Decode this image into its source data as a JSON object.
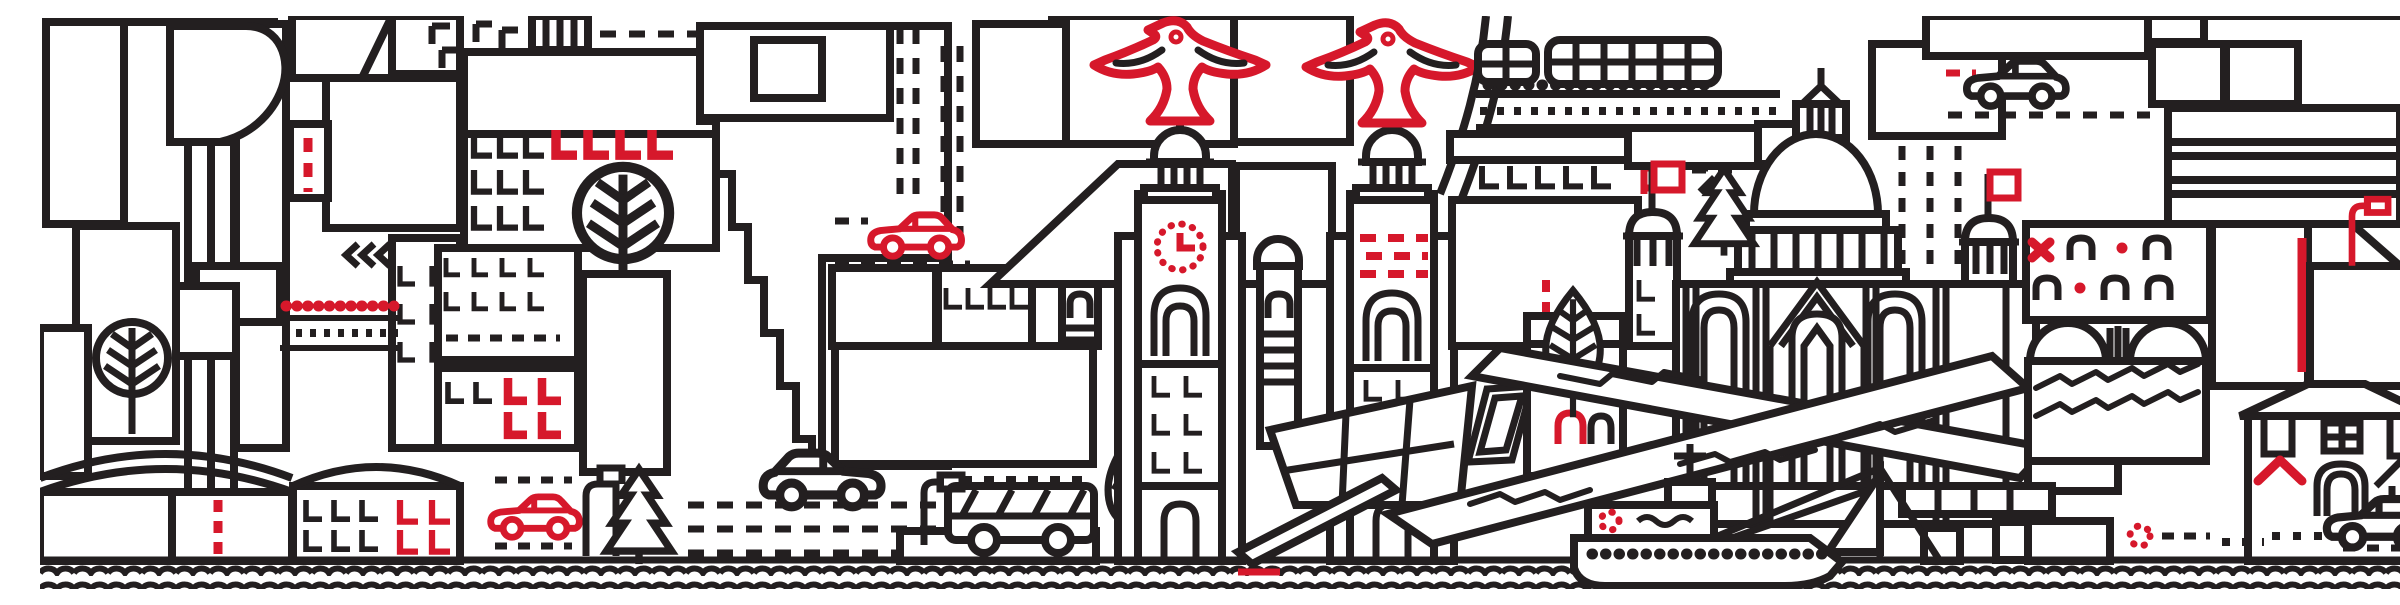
{
  "meta": {
    "title": "Liverpool city skyline line-art illustration",
    "type": "illustration",
    "width_px": 2400,
    "height_px": 573
  },
  "colors": {
    "background": "#ffffff",
    "line": "#231f20",
    "accent": "#d6182b"
  },
  "scene": {
    "description": "Continuous monochrome line-art cityscape of Liverpool with red accents: patterned tower blocks, the Liver Building with two red liver birds and a red dotted clock face, a railway viaduct with a train, a ribbed dome hall with red flags, an arched cathedral facade, crossing museum wedges, a glass ferry terminal, gabled houses, street scenes with cars, a bus, trees and lamps, a ferry ship and sailboat, all above a double wavy waterline.",
    "landmarks": [
      {
        "name": "liver-building-clock-tower",
        "features": [
          "red liver bird finial",
          "domed cupola",
          "red dotted clock face with red hands",
          "arched window",
          "L-shaped window rows"
        ]
      },
      {
        "name": "liver-building-second-tower",
        "features": [
          "red liver bird finial",
          "domed cupola",
          "three red dashed window rows",
          "arched window"
        ]
      },
      {
        "name": "railway-viaduct",
        "features": [
          "curved arch approach",
          "two-car train",
          "dotted wheels",
          "ladder track",
          "red b-shaped window on frieze"
        ]
      },
      {
        "name": "ribbed-dome-hall",
        "features": [
          "vertically ribbed dome",
          "lantern with finial spire",
          "colonnade drum",
          "two red flags on side towers"
        ]
      },
      {
        "name": "arched-facade-cathedral",
        "features": [
          "round-arch windows",
          "pointed central gable"
        ]
      },
      {
        "name": "museum-wedge",
        "features": [
          "two crossing wedge slabs",
          "zigzag wave engravings"
        ]
      },
      {
        "name": "glass-ferry-terminal",
        "features": [
          "trapezoid mullioned window wall",
          "slanted parallelogram window"
        ]
      },
      {
        "name": "wave-roof-arena",
        "features": [
          "double hump roof",
          "zigzag banding"
        ]
      },
      {
        "name": "bent-top-tower",
        "features": [
          "drooping striped crown"
        ]
      },
      {
        "name": "stair-stepped-tower",
        "features": [
          "stepped left edge",
          "grid window inset"
        ]
      }
    ],
    "building_patterns": [
      "horizontal-stripes",
      "vertical-stripes",
      "diagonal-hatch",
      "window-grid",
      "brick",
      "L-shaped-windows",
      "arch-windows",
      "dashed-columns"
    ],
    "vehicles": [
      {
        "name": "red-sedan-street-left",
        "color": "accent"
      },
      {
        "name": "red-sedan-mid-terrace",
        "color": "accent"
      },
      {
        "name": "white-hatchback",
        "color": "line"
      },
      {
        "name": "city-bus",
        "color": "line"
      },
      {
        "name": "black-car-upper-right",
        "color": "line"
      },
      {
        "name": "black-car-houses-right",
        "color": "line"
      },
      {
        "name": "two-car-train",
        "color": "line"
      },
      {
        "name": "ferry-ship",
        "features": [
          "red dashed lifebuoy",
          "porthole dot row",
          "mast with crossbar",
          "rigging lines"
        ]
      },
      {
        "name": "sailboat",
        "color": "line"
      }
    ],
    "nature": [
      {
        "name": "round-tree-lower-left"
      },
      {
        "name": "round-tree-center-left"
      },
      {
        "name": "leaf-tree-bus-stop"
      },
      {
        "name": "leaf-tree-waterfront"
      },
      {
        "name": "pine-tree-street"
      },
      {
        "name": "pine-tree-dome"
      }
    ],
    "street_furniture": [
      {
        "name": "black-street-lamp"
      },
      {
        "name": "red-street-lamp-left"
      },
      {
        "name": "red-street-lamp-right"
      },
      {
        "name": "fence-with-red-dot-row"
      },
      {
        "name": "fuel-pump"
      },
      {
        "name": "pier-ramp"
      }
    ],
    "red_accents": [
      "liver-bird x2",
      "clock-face-and-hands",
      "dashed-window-rows",
      "LLLL-windows",
      "LL-windows",
      "street-lamp x2",
      "flag x2",
      "x-mark",
      "arched-door",
      "roof-chevron",
      "lifebuoy x2",
      "vertical-line",
      "dot-row",
      "car x2",
      "quay-line",
      "b-window",
      "dash-marks"
    ],
    "water": {
      "name": "wavy-waterline",
      "rows": 2
    }
  }
}
